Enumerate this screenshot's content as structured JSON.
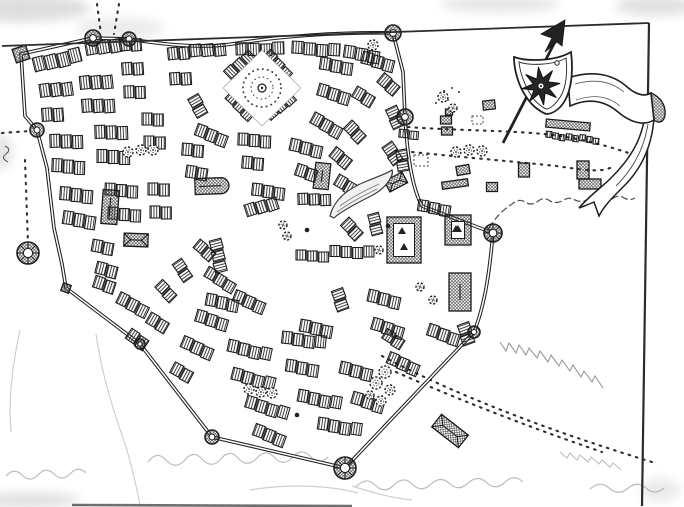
{
  "meta": {
    "kind": "hand-drawn-town-map",
    "media": "pen-and-ink-scan",
    "ink": "#1f1f1f",
    "paper": "#ffffff",
    "pencil": "#b5b5b5",
    "smudge": "#bdbdbd"
  },
  "map": {
    "frame": {
      "top": "M2,46 L649,23",
      "right": "M649,23 L642,506"
    },
    "wall": {
      "path": "M21,54 L93,38 L129,39 C160,44 200,49 232,44 C280,36 340,32 393,33 L403,72 L405,117 C407,150 411,186 422,206 L493,233 C490,266 486,302 474,332 L345,468 L212,437 L140,344 L66,288 L62,264 L54,228 L47,168 L37,130 L25,116 Z",
      "towers": [
        [
          21,
          54,
          7,
          1,
          -18
        ],
        [
          93,
          38,
          8,
          0,
          0
        ],
        [
          129,
          39,
          7,
          0,
          0
        ],
        [
          393,
          33,
          8,
          0,
          0
        ],
        [
          405,
          117,
          8,
          0,
          0
        ],
        [
          493,
          233,
          9,
          0,
          0
        ],
        [
          474,
          332,
          6,
          0,
          0
        ],
        [
          345,
          468,
          11,
          0,
          0
        ],
        [
          212,
          437,
          7,
          0,
          0
        ],
        [
          140,
          344,
          5,
          0,
          0
        ],
        [
          66,
          288,
          4,
          1,
          20
        ],
        [
          37,
          130,
          7,
          0,
          0
        ],
        [
          28,
          253,
          11,
          0,
          0
        ]
      ]
    },
    "blocks_xyanwh": [
      [
        34,
        66,
        -14,
        4,
        11,
        14
      ],
      [
        86,
        50,
        -10,
        3,
        11,
        13
      ],
      [
        120,
        46,
        -4,
        2,
        10,
        12
      ],
      [
        40,
        92,
        -8,
        3,
        10,
        13
      ],
      [
        42,
        116,
        -4,
        2,
        10,
        13
      ],
      [
        80,
        84,
        -6,
        3,
        10,
        13
      ],
      [
        82,
        107,
        -4,
        3,
        10,
        13
      ],
      [
        122,
        70,
        -4,
        2,
        10,
        12
      ],
      [
        124,
        93,
        -2,
        2,
        10,
        12
      ],
      [
        50,
        142,
        -2,
        3,
        10,
        13
      ],
      [
        52,
        166,
        2,
        3,
        10,
        13
      ],
      [
        95,
        133,
        -2,
        3,
        10,
        13
      ],
      [
        97,
        157,
        0,
        3,
        10,
        13
      ],
      [
        142,
        120,
        0,
        2,
        10,
        12
      ],
      [
        144,
        143,
        0,
        2,
        10,
        12
      ],
      [
        60,
        194,
        4,
        3,
        10,
        13
      ],
      [
        63,
        218,
        8,
        3,
        10,
        13
      ],
      [
        105,
        190,
        2,
        3,
        10,
        12
      ],
      [
        108,
        214,
        2,
        3,
        10,
        12
      ],
      [
        148,
        190,
        0,
        2,
        10,
        12
      ],
      [
        150,
        213,
        0,
        2,
        10,
        12
      ],
      [
        168,
        55,
        -6,
        2,
        10,
        12
      ],
      [
        170,
        80,
        -4,
        2,
        10,
        12
      ],
      [
        190,
        52,
        -6,
        3,
        11,
        12
      ],
      [
        236,
        50,
        -2,
        4,
        11,
        12
      ],
      [
        292,
        48,
        3,
        4,
        11,
        12
      ],
      [
        344,
        52,
        8,
        3,
        11,
        12
      ],
      [
        228,
        76,
        -44,
        3,
        10,
        11
      ],
      [
        266,
        54,
        44,
        3,
        10,
        11
      ],
      [
        228,
        95,
        42,
        3,
        10,
        11
      ],
      [
        268,
        117,
        -42,
        3,
        10,
        11
      ],
      [
        192,
        97,
        60,
        2,
        10,
        12
      ],
      [
        196,
        130,
        20,
        3,
        10,
        12
      ],
      [
        320,
        64,
        8,
        3,
        10,
        12
      ],
      [
        362,
        58,
        14,
        3,
        10,
        12
      ],
      [
        318,
        90,
        16,
        3,
        10,
        12
      ],
      [
        354,
        92,
        30,
        2,
        10,
        12
      ],
      [
        312,
        118,
        28,
        3,
        10,
        12
      ],
      [
        347,
        125,
        45,
        2,
        10,
        12
      ],
      [
        380,
        78,
        40,
        2,
        10,
        12
      ],
      [
        390,
        108,
        65,
        2,
        10,
        12
      ],
      [
        386,
        145,
        55,
        2,
        10,
        12
      ],
      [
        332,
        152,
        38,
        2,
        10,
        12
      ],
      [
        400,
        150,
        80,
        2,
        10,
        11
      ],
      [
        399,
        134,
        5,
        2,
        9,
        8
      ],
      [
        182,
        150,
        4,
        2,
        10,
        12
      ],
      [
        186,
        172,
        8,
        2,
        10,
        12
      ],
      [
        238,
        140,
        2,
        3,
        10,
        12
      ],
      [
        242,
        163,
        4,
        2,
        10,
        12
      ],
      [
        290,
        145,
        12,
        3,
        10,
        12
      ],
      [
        296,
        170,
        18,
        2,
        10,
        12
      ],
      [
        336,
        180,
        30,
        2,
        10,
        12
      ],
      [
        252,
        190,
        6,
        3,
        10,
        12
      ],
      [
        246,
        212,
        -18,
        3,
        10,
        12
      ],
      [
        298,
        200,
        -2,
        3,
        10,
        11
      ],
      [
        344,
        222,
        45,
        2,
        10,
        12
      ],
      [
        296,
        256,
        0,
        3,
        10,
        10
      ],
      [
        330,
        252,
        0,
        4,
        10,
        11
      ],
      [
        214,
        240,
        75,
        3,
        10,
        12
      ],
      [
        234,
        296,
        22,
        3,
        10,
        12
      ],
      [
        300,
        326,
        10,
        3,
        10,
        12
      ],
      [
        336,
        290,
        70,
        2,
        10,
        12
      ],
      [
        196,
        244,
        40,
        2,
        10,
        11
      ],
      [
        176,
        262,
        55,
        2,
        10,
        11
      ],
      [
        206,
        272,
        30,
        3,
        10,
        11
      ],
      [
        158,
        284,
        45,
        2,
        10,
        11
      ],
      [
        92,
        246,
        10,
        2,
        10,
        12
      ],
      [
        96,
        268,
        14,
        2,
        10,
        12
      ],
      [
        368,
        296,
        12,
        3,
        10,
        12
      ],
      [
        372,
        324,
        16,
        3,
        10,
        12
      ],
      [
        428,
        330,
        18,
        3,
        10,
        12
      ],
      [
        462,
        324,
        70,
        2,
        10,
        12
      ],
      [
        418,
        206,
        8,
        3,
        10,
        11
      ],
      [
        372,
        214,
        75,
        2,
        10,
        11
      ],
      [
        196,
        316,
        16,
        3,
        10,
        12
      ],
      [
        182,
        342,
        22,
        3,
        10,
        12
      ],
      [
        172,
        368,
        28,
        2,
        10,
        12
      ],
      [
        228,
        346,
        12,
        4,
        10,
        12
      ],
      [
        232,
        374,
        14,
        4,
        10,
        12
      ],
      [
        282,
        338,
        6,
        4,
        10,
        12
      ],
      [
        286,
        366,
        8,
        3,
        10,
        12
      ],
      [
        246,
        402,
        16,
        4,
        10,
        12
      ],
      [
        298,
        396,
        10,
        4,
        10,
        12
      ],
      [
        318,
        424,
        8,
        4,
        10,
        12
      ],
      [
        352,
        398,
        16,
        3,
        10,
        12
      ],
      [
        340,
        368,
        12,
        3,
        10,
        12
      ],
      [
        388,
        358,
        22,
        3,
        10,
        12
      ],
      [
        254,
        430,
        20,
        3,
        10,
        12
      ],
      [
        206,
        300,
        10,
        3,
        10,
        12
      ],
      [
        148,
        318,
        30,
        2,
        10,
        12
      ],
      [
        118,
        298,
        26,
        3,
        10,
        12
      ],
      [
        94,
        282,
        18,
        2,
        10,
        12
      ],
      [
        128,
        334,
        34,
        2,
        10,
        12
      ],
      [
        384,
        334,
        32,
        2,
        10,
        11
      ],
      [
        546,
        135,
        6,
        8,
        5.5,
        6
      ]
    ],
    "landmarks_xyawht": [
      [
        110,
        207,
        4,
        16,
        34,
        "hip"
      ],
      [
        212,
        186,
        -2,
        34,
        16,
        "apse"
      ],
      [
        322,
        176,
        6,
        15,
        26,
        "hip"
      ],
      [
        136,
        240,
        2,
        24,
        13,
        "hip"
      ],
      [
        396,
        182,
        -28,
        20,
        12,
        "hip"
      ],
      [
        404,
        240,
        0,
        34,
        46,
        "court"
      ],
      [
        458,
        230,
        0,
        26,
        30,
        "court"
      ],
      [
        460,
        292,
        0,
        22,
        38,
        "hip"
      ],
      [
        450,
        431,
        38,
        34,
        16,
        "hip"
      ],
      [
        568,
        125,
        5,
        44,
        8,
        "hip"
      ],
      [
        583,
        170,
        0,
        12,
        18,
        "hip"
      ],
      [
        590,
        184,
        0,
        22,
        10,
        "hip"
      ],
      [
        524,
        170,
        0,
        11,
        14,
        "hip"
      ],
      [
        489,
        105,
        -6,
        12,
        9,
        "hip"
      ],
      [
        446,
        120,
        0,
        11,
        8,
        "hip"
      ],
      [
        447,
        131,
        0,
        11,
        8,
        "hip"
      ],
      [
        463,
        170,
        -10,
        13,
        9,
        "hip"
      ],
      [
        455,
        184,
        -8,
        26,
        7,
        "hip"
      ],
      [
        492,
        187,
        0,
        11,
        9,
        "hip"
      ],
      [
        449,
        112,
        0,
        7,
        6,
        "hip"
      ]
    ],
    "trees_xyr": [
      [
        128,
        152,
        5
      ],
      [
        141,
        150,
        5
      ],
      [
        153,
        150,
        5
      ],
      [
        456,
        152,
        5
      ],
      [
        469,
        150,
        5
      ],
      [
        482,
        151,
        5
      ],
      [
        249,
        389,
        5
      ],
      [
        261,
        392,
        5
      ],
      [
        272,
        393,
        5
      ],
      [
        283,
        225,
        4
      ],
      [
        287,
        236,
        4
      ],
      [
        379,
        250,
        4
      ],
      [
        420,
        287,
        4
      ],
      [
        433,
        300,
        4
      ],
      [
        443,
        97,
        5
      ],
      [
        453,
        108,
        4
      ],
      [
        385,
        372,
        6
      ],
      [
        376,
        383,
        6
      ],
      [
        390,
        390,
        5
      ],
      [
        381,
        401,
        5
      ],
      [
        370,
        395,
        4
      ],
      [
        373,
        45,
        5
      ]
    ],
    "scatter_dots": [
      [
        444,
        91
      ],
      [
        452,
        88
      ],
      [
        459,
        92
      ],
      [
        448,
        100
      ],
      [
        436,
        103
      ]
    ],
    "wells_dark": [
      [
        307,
        230
      ],
      [
        388,
        226
      ],
      [
        297,
        415
      ]
    ],
    "market": {
      "diamond": "262,50 301,88 262,126 223,88",
      "cx": 262,
      "cy": 88,
      "ring_r": 19,
      "inner_r": 11,
      "well_r": 4
    },
    "pond": {
      "outline": "M330,216 C334,199 349,188 367,181 C377,177 388,173 392,170 C394,175 387,188 371,196 C355,204 340,212 334,218 Z",
      "inner": [
        "M340,206 C352,197 366,190 379,184",
        "M337,212 C349,203 363,196 377,189"
      ]
    },
    "dotted_paths": [
      "M97,4 L101,34",
      "M119,4 L114,34",
      "M2,133 L30,131",
      "M25,160 L28,243",
      "M408,127 C460,131 520,130 560,136 C592,141 622,150 642,158",
      "M412,152 C470,158 520,162 556,166 C578,169 598,173 610,168",
      "M382,356 C450,392 540,428 652,462",
      "M396,372 C450,396 520,424 602,452"
    ],
    "plots": [
      [
        414,
        155,
        14,
        11
      ],
      [
        472,
        116,
        11,
        8
      ]
    ],
    "hedge": "M489,228 Q499,212 512,204 q7,-6 13,-2 q6,4 12,0 q7,-6 13,-1 q6,3 12,0 q7,-5 13,-1 q6,3 12,0 q7,-5 13,-1 q6,3 12,0 q7,-5 12,-1 q6,3 11,0",
    "zigzags": [
      [
        "M500,342 l6,9 l3,-8 l7,10 l3,-8 l7,10 l3,-7 l8,10 l3,-7 l8,11 l3,-7 l8,11 l3,-6 l8,11 l3,-6 l8,12 l3,-6 l8,11 l3,-6 l8,12",
        "#999999"
      ],
      [
        "M560,452 l7,6 l3,-5 l7,7 l3,-5 l8,7 l3,-5 l8,7 l3,-4 l8,7 l3,-4 l8,7",
        "#bcbcbc"
      ]
    ],
    "waves": [
      "M148,462 q9,-12 18,-2 q9,10 18,1 q9,-12 18,-2 q9,10 18,1 q9,-12 18,-2 q9,10 18,1 q9,-11 18,-2 q9,10 18,1 q9,-11 18,-2 q9,10 18,1",
      "M356,487 q10,-11 19,-2 q9,9 18,1 q10,-11 19,-2 q9,9 18,1 q10,-10 19,-2 q9,9 18,1 q10,-10 19,-2 q9,9 18,1 q10,-10 19,-1",
      "M590,489 q10,-9 19,-1 q9,8 18,1 q10,-9 19,-1 q9,8 18,0",
      "M6,476 q8,-9 16,-1 q8,8 16,0 q8,-9 16,-1 q8,8 16,0 q8,-9 16,-1"
    ],
    "contours": [
      "M96,334 C102,378 116,418 127,450 C132,468 137,488 140,506",
      "M20,330 C13,362 8,398 11,432",
      "M250,490 C292,483 332,486 358,493",
      "M352,486 C370,492 392,498 412,500"
    ],
    "streak": "M72,505 L352,506",
    "squiggle": "M5,146 q7,3 1,8 q-6,4 2,8",
    "smudges": [
      [
        20,
        8,
        70,
        14,
        0.5
      ],
      [
        500,
        4,
        60,
        8,
        0.4
      ],
      [
        655,
        6,
        40,
        10,
        0.45
      ],
      [
        2,
        152,
        10,
        18,
        0.4
      ],
      [
        30,
        500,
        50,
        8,
        0.45
      ],
      [
        120,
        28,
        44,
        10,
        0.3
      ],
      [
        660,
        490,
        20,
        12,
        0.3
      ]
    ],
    "banner": {
      "shield_outer": "M514,57 C528,62 556,61 571,52 C574,76 570,95 562,105 C557,111 551,114 546,114 C541,112 533,107 527,98 C519,87 514,71 514,57 Z",
      "shield_inner": "M519,62 C530,66 554,65 566,58 C568,77 565,92 558,100 C554,106 549,109 546,109 C542,107 536,103 531,95 C525,86 520,73 519,62 Z",
      "star": {
        "cx": 541,
        "cy": 86,
        "R": 19,
        "r": 8,
        "n": 8,
        "rot": -8
      },
      "ring_deco": [
        557,
        63,
        2.2
      ],
      "spear_shaft": "M503,143 L560,32",
      "arrowhead": "M565,20 L541,34 L552,38 L545,52 L557,42 L562,46 Z",
      "band": "M568,78 C592,70 612,74 626,86 C636,95 644,97 651,93 L654,120 C644,126 631,123 618,112 C604,100 588,98 570,106 Z",
      "creases": [
        "M575,84 C596,78 612,82 624,92",
        "M576,100 C594,94 608,96 620,106"
      ],
      "fold": "M651,93 C661,97 666,106 665,115 C664,122 659,124 654,120 Z",
      "tail": "M654,118 C652,146 641,170 622,188 C612,198 604,206 599,216 L594,202 C590,204 584,206 579,208 C589,196 601,188 611,178 C629,160 641,142 645,116 Z",
      "tail_crease": "M648,124 C644,150 632,170 616,186"
    }
  }
}
